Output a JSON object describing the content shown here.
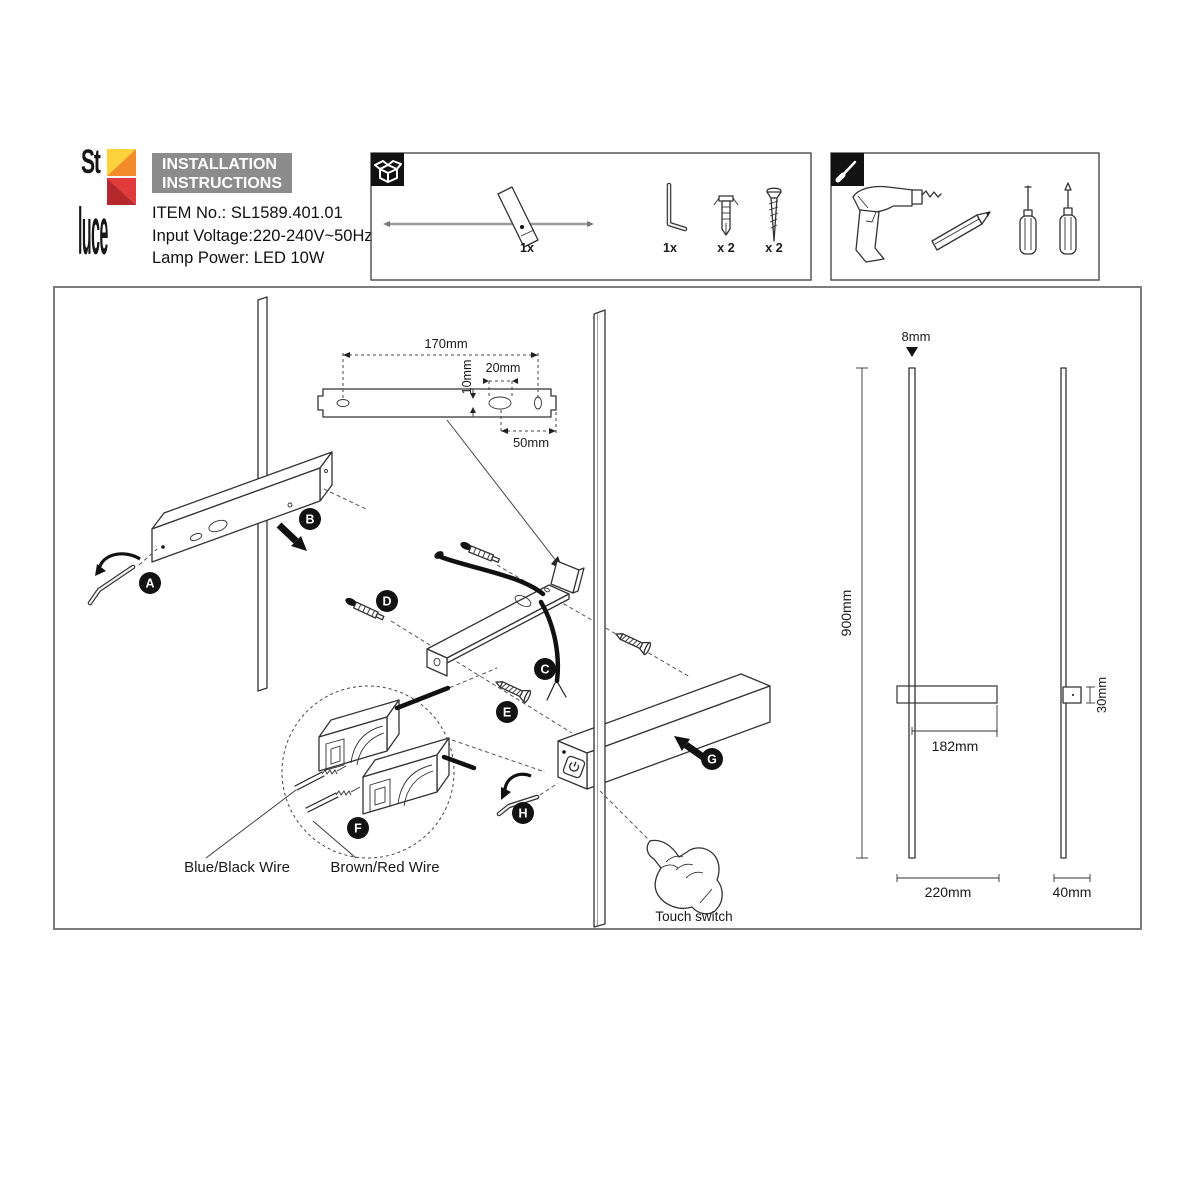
{
  "header": {
    "brand_top": "St",
    "brand_bottom": "luce",
    "title_line1": "INSTALLATION",
    "title_line2": "INSTRUCTIONS",
    "item_no": "ITEM No.: SL1589.401.01",
    "input_voltage": "Input Voltage:220-240V~50Hz",
    "lamp_power": "Lamp Power: LED 10W"
  },
  "package_box": {
    "lamp_qty": "1x",
    "hex_key_qty": "1x",
    "anchor_qty": "x 2",
    "screw_qty": "x 2"
  },
  "steps": {
    "a": "A",
    "b": "B",
    "c": "C",
    "d": "D",
    "e": "E",
    "f": "F",
    "g": "G",
    "h": "H"
  },
  "dims": {
    "bracket_length": "170mm",
    "hole_offset": "10mm",
    "slot_width": "20mm",
    "slot_offset": "50mm",
    "rod_diameter": "8mm",
    "fixture_height": "900mm",
    "body_length": "182mm",
    "body_depth": "30mm",
    "width_front": "220mm",
    "width_side": "40mm"
  },
  "labels": {
    "blue_black": "Blue/Black Wire",
    "brown_red": "Brown/Red Wire",
    "touch": "Touch switch"
  },
  "colors": {
    "logo_yellow": "#ffd23b",
    "logo_orange": "#f28c28",
    "logo_red": "#e03a3c",
    "logo_dark_red": "#b5282c",
    "header_bg": "#8c8c8c",
    "line": "#333333"
  }
}
